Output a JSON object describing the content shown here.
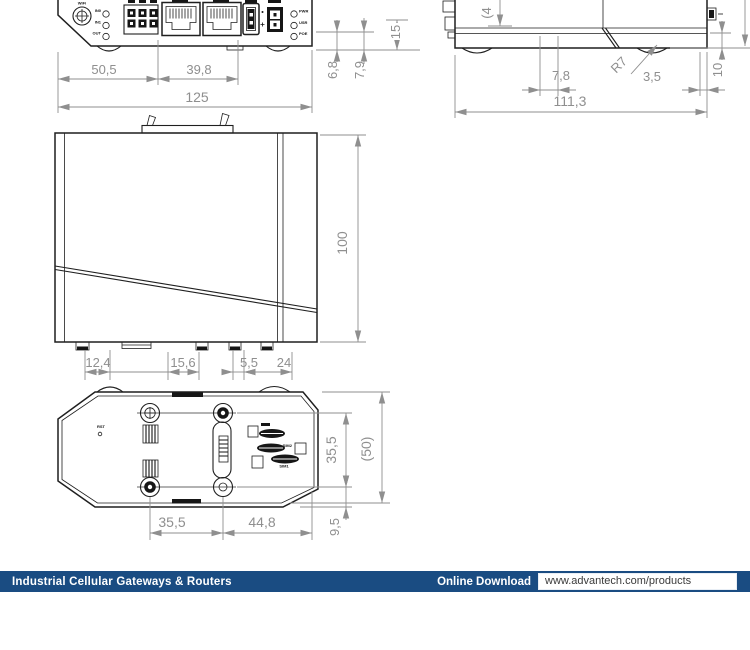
{
  "colors": {
    "device_line": "#1f1f1f",
    "dimension": "#8f8f8f",
    "footer_bar": "#1a4c82"
  },
  "front_view": {
    "dims": {
      "w_left": "50,5",
      "w_mid": "39,8",
      "w_total": "125",
      "h_small": "6,8",
      "h_mid": "7,9",
      "h_large": "15"
    },
    "labels": {
      "antenna": "WiFi",
      "in0": "IN0",
      "in1": "IN1",
      "out": "OUT",
      "pwr": "PWR",
      "usr": "USR",
      "poe": "POE"
    }
  },
  "side_view": {
    "dims": {
      "foot_left": "7,8",
      "corner_radius": "R7",
      "foot_right": "3,5",
      "depth": "111,3",
      "height_partial": "(4",
      "edge": "10"
    }
  },
  "main_view": {
    "dims": {
      "height": "100",
      "seg1": "12,4",
      "seg2": "15,6",
      "seg3": "5,5",
      "seg4": "24"
    }
  },
  "bottom_view": {
    "dims": {
      "screw_span_v": "35,5",
      "total_height": "(50)",
      "foot_offset": "9,5",
      "screw_span_h": "35,5",
      "screw_right": "44,8"
    },
    "labels": {
      "reset": "RST",
      "sim_upper": "SIM2",
      "sim_lower": "SIM1"
    }
  },
  "footer": {
    "title": "Industrial Cellular Gateways & Routers",
    "download_label": "Online Download",
    "url": "www.advantech.com/products"
  }
}
